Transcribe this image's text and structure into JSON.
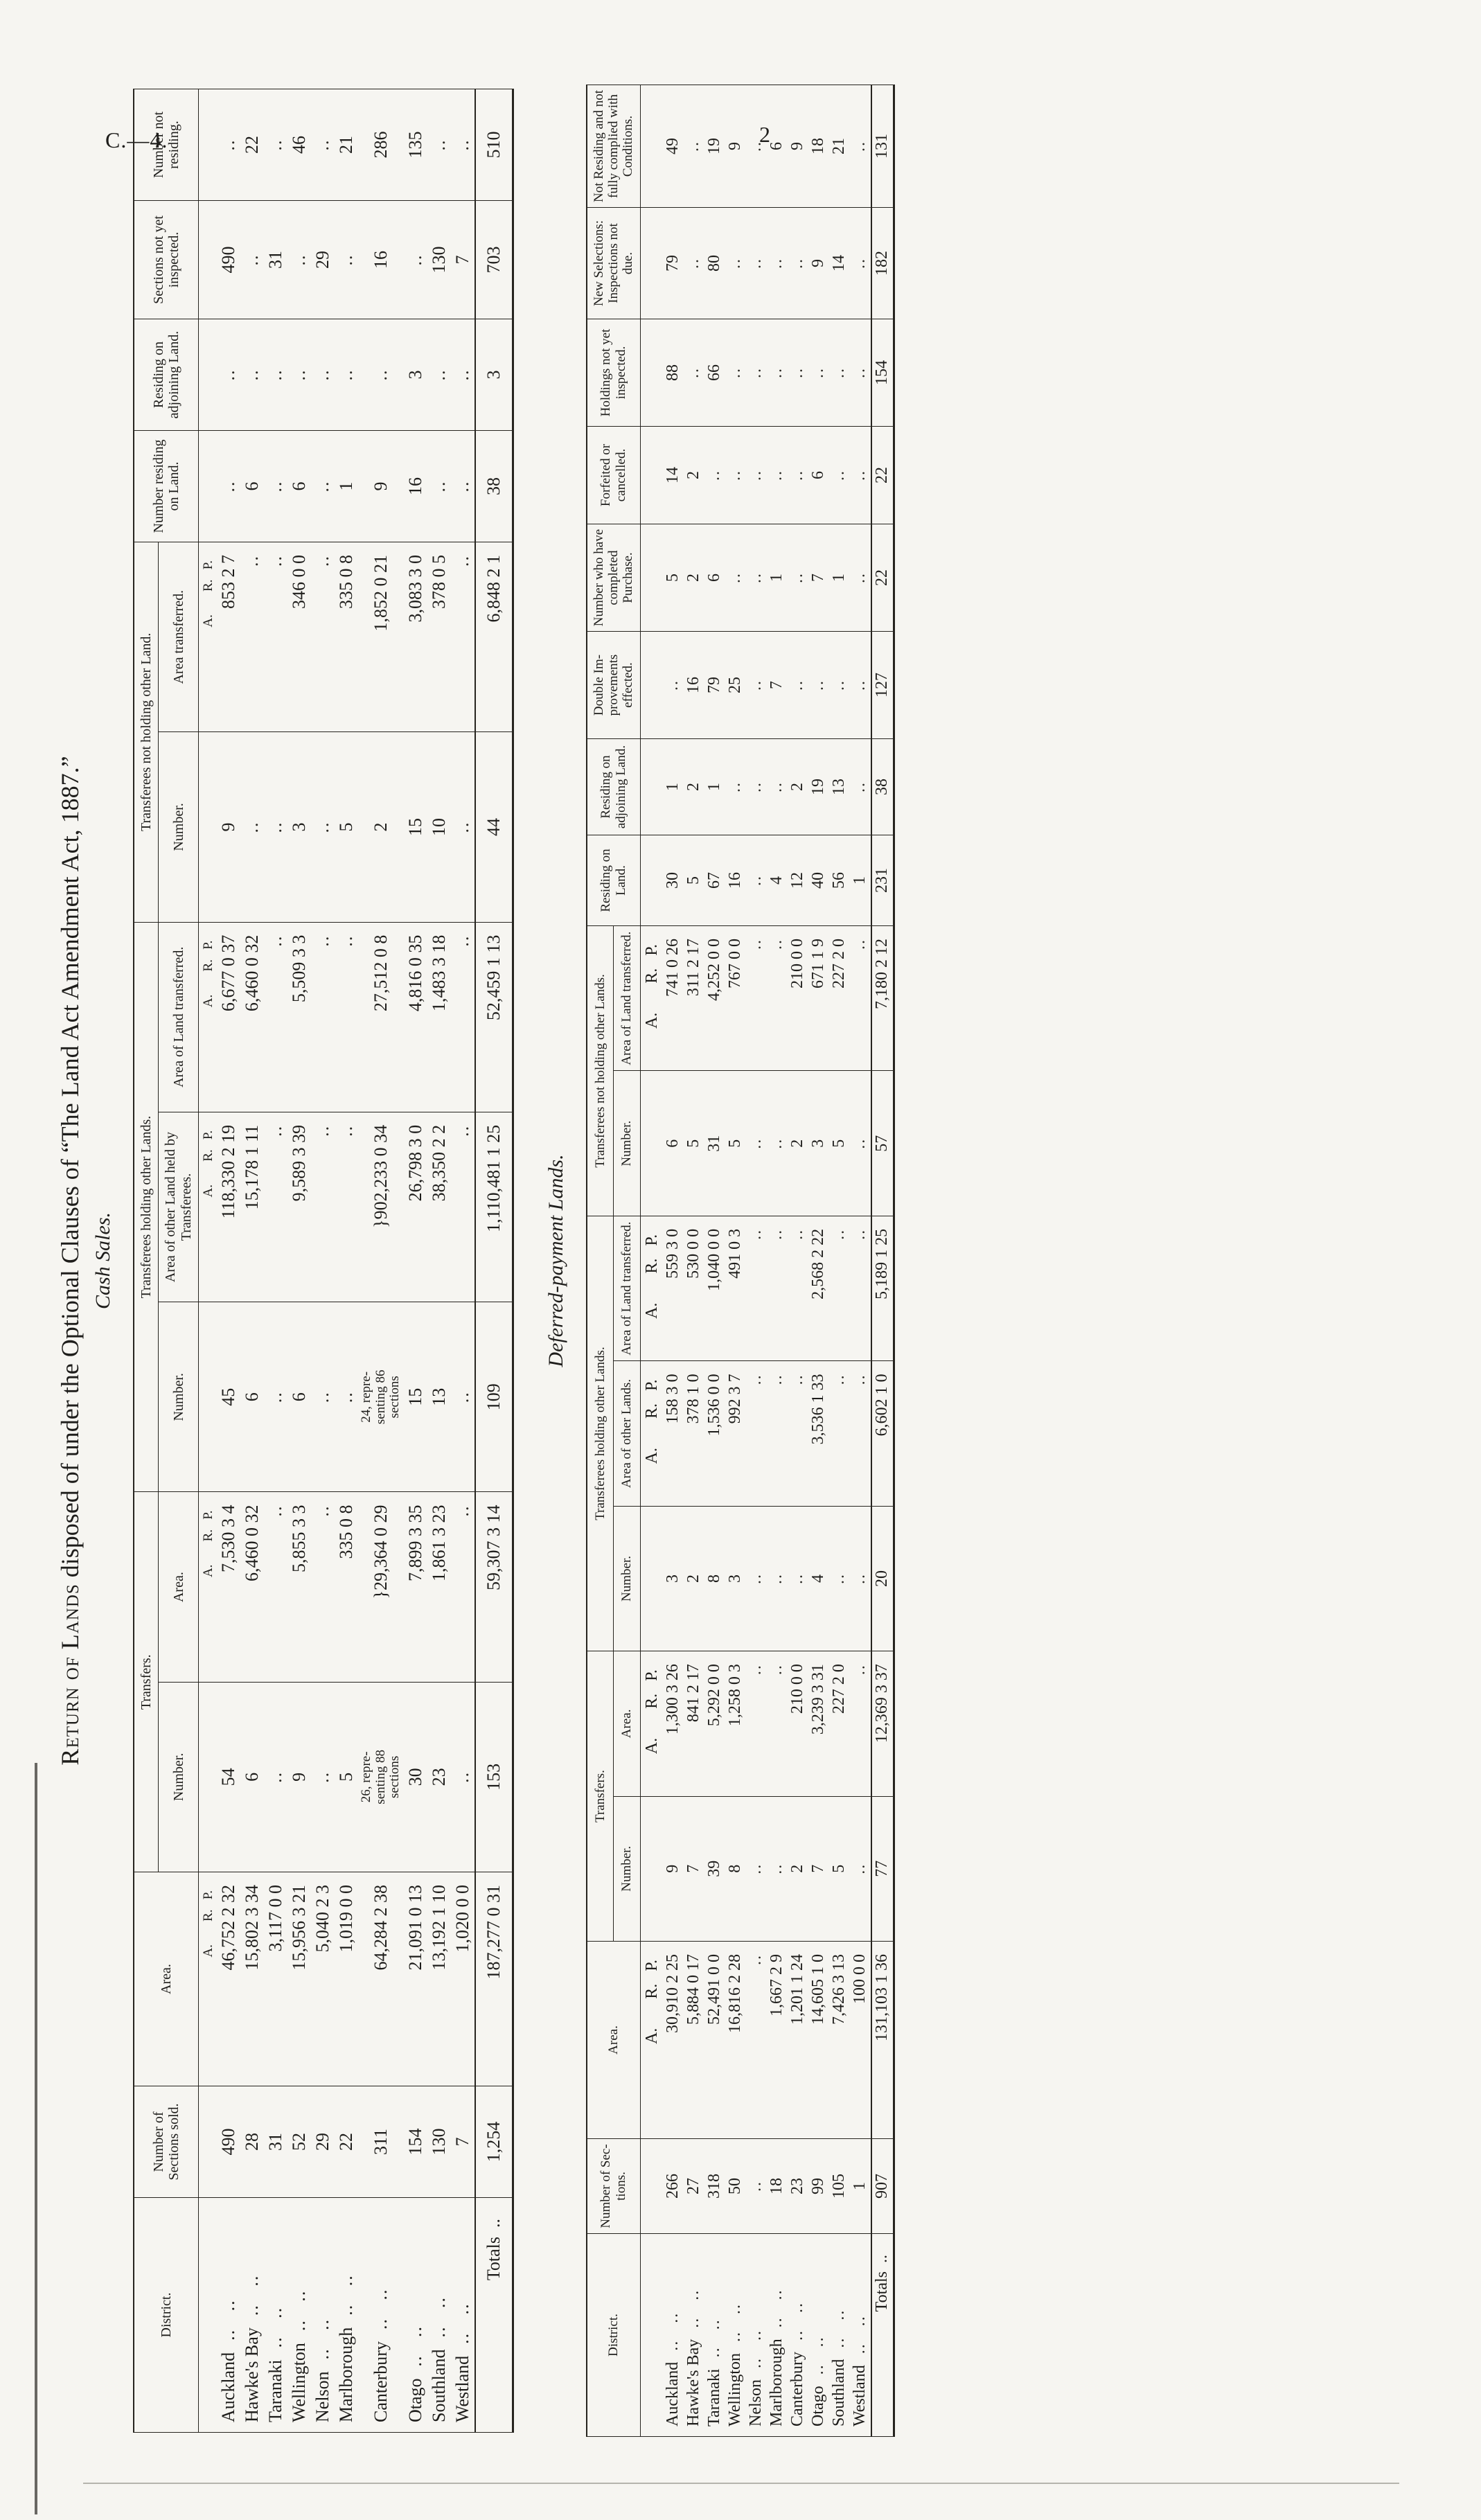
{
  "page": {
    "doc_ref": "C.—4.",
    "page_number": "2"
  },
  "title": {
    "lead": "Return of Lands",
    "rest": " disposed of under the Optional Clauses of ",
    "quote": "“The Land Act Amendment Act, 1887.”"
  },
  "subtitle_cash": "Cash Sales.",
  "subtitle_deferred": "Deferred-payment Lands.",
  "leader_dots": "  ..   ..",
  "totals_leader": "  ..",
  "arp_label": "A.       R.   P.",
  "cash": {
    "h": {
      "district": "District.",
      "sections": "Number of Sections sold.",
      "area": "Area.",
      "transfers": "Transfers.",
      "number": "Number.",
      "tr_area": "Area.",
      "holding": "Transferees holding other Lands.",
      "h_num": "Number.",
      "h_area_other": "Area of other Land held by Transferees.",
      "h_area_tr": "Area of Land transferred.",
      "not_holding": "Transferees not holding other Land.",
      "nh_num": "Number.",
      "nh_area": "Area transferred.",
      "res_land": "Number residing on Land.",
      "res_adj": "Residing on adjoining Land.",
      "sec_ni": "Sections not yet inspected.",
      "not_res": "Number not residing."
    },
    "col_types": [
      "d",
      "n",
      "a",
      "n",
      "a",
      "n",
      "a",
      "a",
      "n",
      "a",
      "n",
      "n",
      "n",
      "n"
    ],
    "rows": [
      [
        "Auckland",
        "490",
        "46,752 2 32",
        "54",
        "7,530 3 4",
        "45",
        "118,330 2 19",
        "6,677 0 37",
        "9",
        "853 2 7",
        "..",
        "..",
        "490",
        ".."
      ],
      [
        "Hawke's Bay",
        "28",
        "15,802 3 34",
        "6",
        "6,460 0 32",
        "6",
        "15,178 1 11",
        "6,460 0 32",
        "..",
        "..",
        "6",
        "..",
        "..",
        "22"
      ],
      [
        "Taranaki",
        "31",
        "3,117 0 0",
        "..",
        "..",
        "..",
        "..",
        "..",
        "..",
        "..",
        "..",
        "..",
        "31",
        ".."
      ],
      [
        "Wellington",
        "52",
        "15,956 3 21",
        "9",
        "5,855 3 3",
        "6",
        "9,589 3 39",
        "5,509 3 3",
        "3",
        "346 0 0",
        "6",
        "..",
        "..",
        "46"
      ],
      [
        "Nelson",
        "29",
        "5,040 2 3",
        "..",
        "..",
        "..",
        "..",
        "..",
        "..",
        "..",
        "..",
        "..",
        "29",
        ".."
      ],
      [
        "Marlborough",
        "22",
        "1,019 0 0",
        "5",
        "335 0 8",
        "..",
        "..",
        "..",
        "5",
        "335 0 8",
        "1",
        "..",
        "..",
        "21"
      ],
      [
        "Canterbury",
        "311",
        "64,284 2 38",
        "26, repre-\nsenting 88\nsections",
        "}29,364 0 29",
        "24, repre-\nsenting 86\nsections",
        "}902,233 0 34",
        "27,512 0 8",
        "2",
        "1,852 0 21",
        "9",
        "..",
        "16",
        "286"
      ],
      [
        "Otago",
        "154",
        "21,091 0 13",
        "30",
        "7,899 3 35",
        "15",
        "26,798 3 0",
        "4,816 0 35",
        "15",
        "3,083 3 0",
        "16",
        "3",
        "..",
        "135"
      ],
      [
        "Southland",
        "130",
        "13,192 1 10",
        "23",
        "1,861 3 23",
        "13",
        "38,350 2 2",
        "1,483 3 18",
        "10",
        "378 0 5",
        "..",
        "..",
        "130",
        ".."
      ],
      [
        "Westland",
        "7",
        "1,020 0 0",
        "..",
        "..",
        "..",
        "..",
        "..",
        "..",
        "..",
        "..",
        "..",
        "7",
        ".."
      ]
    ],
    "totals_label": "Totals",
    "totals": [
      "1,254",
      "187,277 0 31",
      "153",
      "59,307 3 14",
      "109",
      "1,110,481 1 25",
      "52,459 1 13",
      "44",
      "6,848 2 1",
      "38",
      "3",
      "703",
      "510"
    ]
  },
  "deferred": {
    "h": {
      "district": "District.",
      "sections": "Number of Sec-tions.",
      "area": "Area.",
      "transfers": "Transfers.",
      "number": "Number.",
      "tr_area": "Area.",
      "holding": "Transferees holding other Lands.",
      "h_num": "Number.",
      "h_area_other": "Area of other Lands.",
      "h_area_tr": "Area of Land transferred.",
      "not_holding": "Transferees not holding other Lands.",
      "nh_num": "Number.",
      "nh_area": "Area of Land transferred.",
      "res_land": "Residing on Land.",
      "res_adj": "Residing on adjoining Land.",
      "dbl_imp": "Double Im-provements effected.",
      "completed": "Number who have completed Purchase.",
      "forfeited": "Forfeited or cancelled.",
      "holdings_ni": "Holdings not yet inspected.",
      "new_sel": "New Selections: Inspections not due.",
      "not_res": "Not Residing and not fully complied with Conditions."
    },
    "col_types": [
      "d",
      "n",
      "a",
      "n",
      "a",
      "n",
      "a",
      "a",
      "n",
      "a",
      "n",
      "n",
      "n",
      "n",
      "n",
      "n",
      "n",
      "n"
    ],
    "rows": [
      [
        "Auckland",
        "266",
        "30,910 2 25",
        "9",
        "1,300 3 26",
        "3",
        "158 3 0",
        "559 3 0",
        "6",
        "741 0 26",
        "30",
        "1",
        "..",
        "5",
        "14",
        "88",
        "79",
        "49"
      ],
      [
        "Hawke's Bay",
        "27",
        "5,884 0 17",
        "7",
        "841 2 17",
        "2",
        "378 1 0",
        "530 0 0",
        "5",
        "311 2 17",
        "5",
        "2",
        "16",
        "2",
        "2",
        "..",
        "..",
        ".."
      ],
      [
        "Taranaki",
        "318",
        "52,491 0 0",
        "39",
        "5,292 0 0",
        "8",
        "1,536 0 0",
        "1,040 0 0",
        "31",
        "4,252 0 0",
        "67",
        "1",
        "79",
        "6",
        "..",
        "66",
        "80",
        "19"
      ],
      [
        "Wellington",
        "50",
        "16,816 2 28",
        "8",
        "1,258 0 3",
        "3",
        "992 3 7",
        "491 0 3",
        "5",
        "767 0 0",
        "16",
        "..",
        "25",
        "..",
        "..",
        "..",
        "..",
        "9"
      ],
      [
        "Nelson",
        "..",
        "..",
        "..",
        "..",
        "..",
        "..",
        "..",
        "..",
        "..",
        "..",
        "..",
        "..",
        "..",
        "..",
        "..",
        "..",
        ".."
      ],
      [
        "Marlborough",
        "18",
        "1,667 2 9",
        "..",
        "..",
        "..",
        "..",
        "..",
        "..",
        "..",
        "4",
        "..",
        "7",
        "1",
        "..",
        "..",
        "..",
        "6"
      ],
      [
        "Canterbury",
        "23",
        "1,201 1 24",
        "2",
        "210 0 0",
        "..",
        "..",
        "..",
        "2",
        "210 0 0",
        "12",
        "2",
        "..",
        "..",
        "..",
        "..",
        "..",
        "9"
      ],
      [
        "Otago",
        "99",
        "14,605 1 0",
        "7",
        "3,239 3 31",
        "4",
        "3,536 1 33",
        "2,568 2 22",
        "3",
        "671 1 9",
        "40",
        "19",
        "..",
        "7",
        "6",
        "..",
        "9",
        "18"
      ],
      [
        "Southland",
        "105",
        "7,426 3 13",
        "5",
        "227 2 0",
        "..",
        "..",
        "..",
        "5",
        "227 2 0",
        "56",
        "13",
        "..",
        "1",
        "..",
        "..",
        "14",
        "21"
      ],
      [
        "Westland",
        "1",
        "100 0 0",
        "..",
        "..",
        "..",
        "..",
        "..",
        "..",
        "..",
        "1",
        "..",
        "..",
        "..",
        "..",
        "..",
        "..",
        ".."
      ]
    ],
    "totals_label": "Totals",
    "totals": [
      "907",
      "131,103 1 36",
      "77",
      "12,369 3 37",
      "20",
      "6,602 1 0",
      "5,189 1 25",
      "57",
      "7,180 2 12",
      "231",
      "38",
      "127",
      "22",
      "22",
      "154",
      "182",
      "131"
    ]
  }
}
